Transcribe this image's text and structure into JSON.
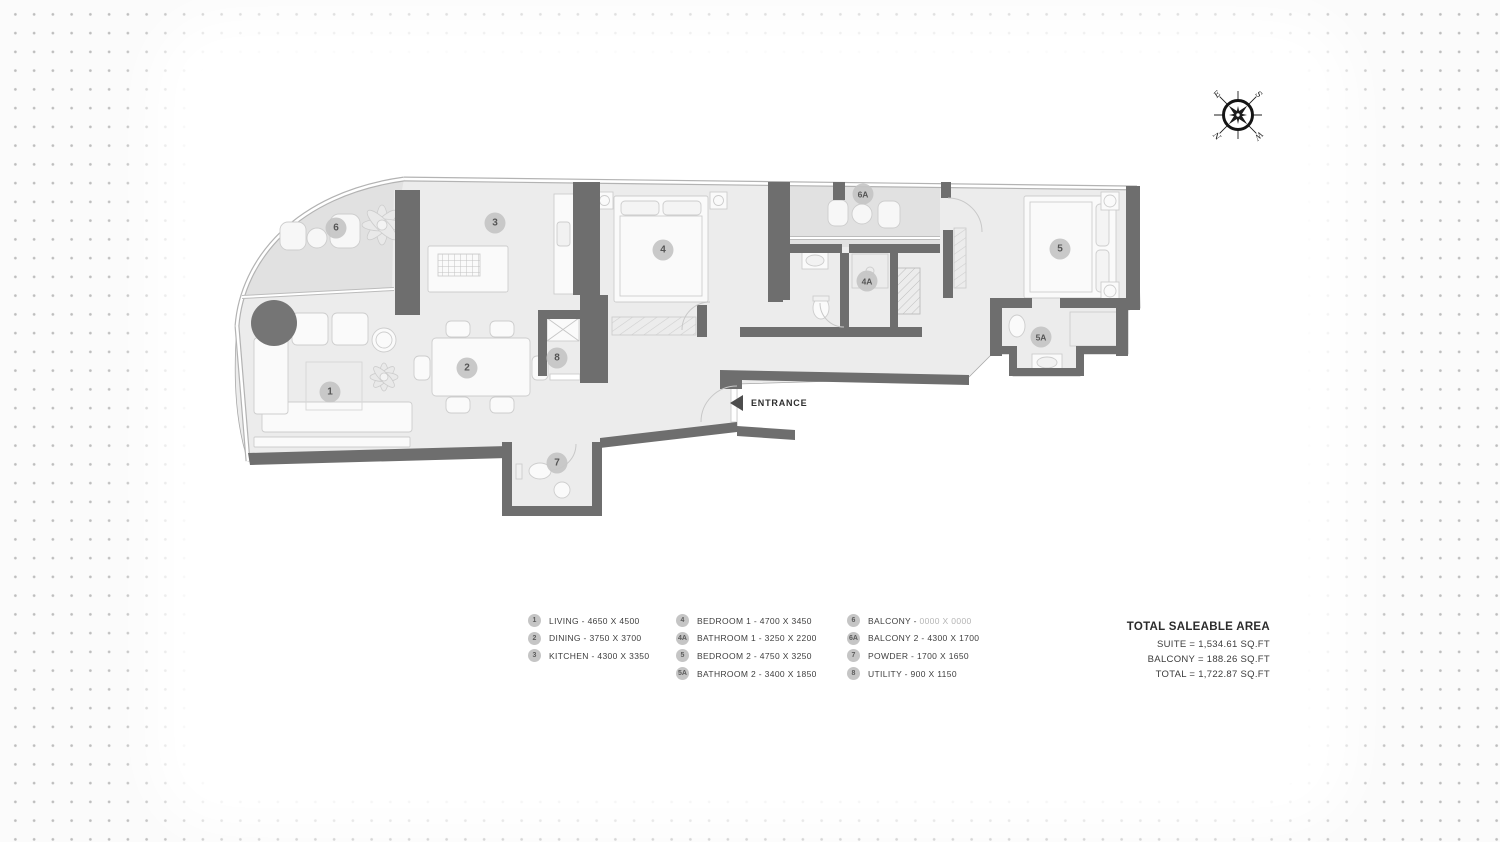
{
  "plan": {
    "entrance_label": "ENTRANCE",
    "markers": [
      "1",
      "2",
      "3",
      "4",
      "4A",
      "5",
      "5A",
      "6",
      "6A",
      "7",
      "8"
    ]
  },
  "legend": {
    "columns": [
      {
        "items": [
          {
            "m": "1",
            "label": "LIVING - 4650 X 4500"
          },
          {
            "m": "2",
            "label": "DINING - 3750 X 3700"
          },
          {
            "m": "3",
            "label": "KITCHEN - 4300 X 3350"
          }
        ]
      },
      {
        "items": [
          {
            "m": "4",
            "label": "BEDROOM 1 - 4700 X 3450"
          },
          {
            "m": "4A",
            "label": "BATHROOM 1 - 3250 X 2200"
          },
          {
            "m": "5",
            "label": "BEDROOM 2 - 4750 X 3250"
          },
          {
            "m": "5A",
            "label": "BATHROOM 2 - 3400 X 1850"
          }
        ]
      },
      {
        "items": [
          {
            "m": "6",
            "label": "BALCONY - ",
            "dims_muted": "0000 X 0000"
          },
          {
            "m": "6A",
            "label": "BALCONY 2 - 4300 X 1700"
          },
          {
            "m": "7",
            "label": "POWDER - 1700 X 1650"
          },
          {
            "m": "8",
            "label": "UTILITY - 900 X 1150"
          }
        ]
      }
    ]
  },
  "totals": {
    "title": "TOTAL SALEABLE AREA",
    "lines": [
      "SUITE =  1,534.61  SQ.FT",
      "BALCONY =  188.26  SQ.FT",
      "TOTAL =  1,722.87  SQ.FT"
    ]
  },
  "compass": {
    "n": "N",
    "e": "E",
    "s": "S",
    "w": "W"
  },
  "colors": {
    "wall": "#6e6e6e",
    "floor": "#ececec",
    "balcony_floor": "#e1e1e1",
    "marker": "#c6c6c6",
    "dot_grid": "#bdbdbd"
  }
}
